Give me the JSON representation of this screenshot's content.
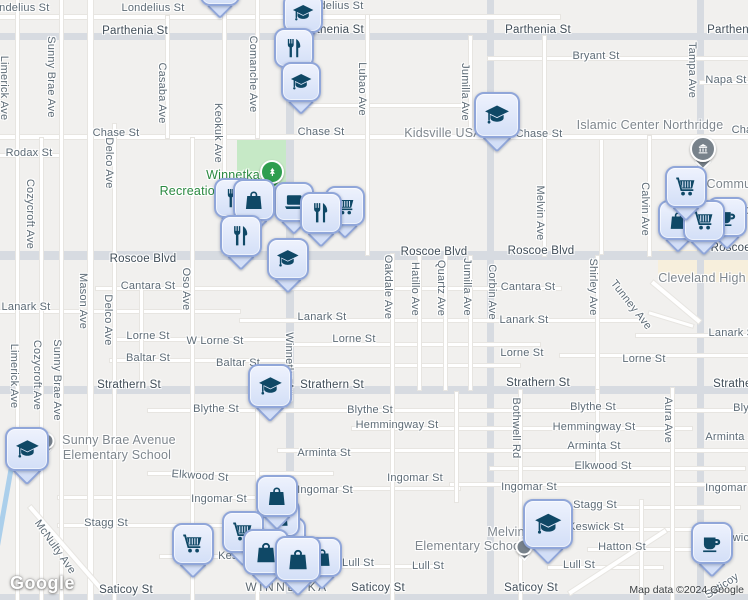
{
  "map_title": "Winnetka area street map",
  "colors": {
    "background": "#f1f0ee",
    "major_road": "#d7dbe1",
    "local_road": "#ffffff",
    "park": "#c6e9c6",
    "water": "#abcfeb",
    "marker_fill": "#d9e3f8",
    "marker_border": "#90a6d9",
    "marker_glyph": "#0f4866",
    "park_pin": "#2e9e4f",
    "institution_pin": "#78828b",
    "street_text": "#5d6b76",
    "major_street_text": "#3f4c57",
    "area_text": "#7e868d",
    "green_text": "#2b8a41"
  },
  "labels": [
    {
      "t": "Londelius St",
      "x": 18,
      "y": 8,
      "r": 0,
      "c": "s"
    },
    {
      "t": "Londelius St",
      "x": 153,
      "y": 8,
      "r": 0,
      "c": "s"
    },
    {
      "t": "Londelius St",
      "x": 332,
      "y": 6,
      "r": 0,
      "c": "s"
    },
    {
      "t": "Parthenia St",
      "x": 135,
      "y": 31,
      "r": 0,
      "c": "m"
    },
    {
      "t": "Parthenia St",
      "x": 331,
      "y": 30,
      "r": 0,
      "c": "m"
    },
    {
      "t": "Parthenia St",
      "x": 538,
      "y": 30,
      "r": 0,
      "c": "m"
    },
    {
      "t": "Parthenia St",
      "x": 740,
      "y": 30,
      "r": 0,
      "c": "m"
    },
    {
      "t": "Bryant St",
      "x": 596,
      "y": 56,
      "r": 0,
      "c": "s"
    },
    {
      "t": "Napa St",
      "x": 726,
      "y": 80,
      "r": 0,
      "c": "s"
    },
    {
      "t": "Chase St",
      "x": 116,
      "y": 133,
      "r": 0,
      "c": "s"
    },
    {
      "t": "Chase St",
      "x": 321,
      "y": 132,
      "r": 0,
      "c": "s"
    },
    {
      "t": "Chase St",
      "x": 539,
      "y": 134,
      "r": 0,
      "c": "s"
    },
    {
      "t": "Chase St",
      "x": 755,
      "y": 130,
      "r": 0,
      "c": "s"
    },
    {
      "t": "Rodax St",
      "x": 29,
      "y": 153,
      "r": 0,
      "c": "s"
    },
    {
      "t": "Roscoe Blvd",
      "x": 143,
      "y": 259,
      "r": 0,
      "c": "m"
    },
    {
      "t": "Roscoe Blvd",
      "x": 434,
      "y": 252,
      "r": 0,
      "c": "m"
    },
    {
      "t": "Roscoe Blvd",
      "x": 541,
      "y": 251,
      "r": 0,
      "c": "m"
    },
    {
      "t": "Roscoe Blvd",
      "x": 744,
      "y": 248,
      "r": 0,
      "c": "m"
    },
    {
      "t": "Cantara St",
      "x": 148,
      "y": 286,
      "r": 0,
      "c": "s"
    },
    {
      "t": "Cantara St",
      "x": 528,
      "y": 287,
      "r": 0,
      "c": "s"
    },
    {
      "t": "Lanark St",
      "x": 26,
      "y": 307,
      "r": 0,
      "c": "s"
    },
    {
      "t": "Lanark St",
      "x": 322,
      "y": 317,
      "r": 0,
      "c": "s"
    },
    {
      "t": "Lanark St",
      "x": 524,
      "y": 320,
      "r": 0,
      "c": "s"
    },
    {
      "t": "Lanark St",
      "x": 733,
      "y": 333,
      "r": 0,
      "c": "s"
    },
    {
      "t": "Lorne St",
      "x": 148,
      "y": 336,
      "r": 0,
      "c": "s"
    },
    {
      "t": "W Lorne St",
      "x": 215,
      "y": 341,
      "r": 0,
      "c": "s"
    },
    {
      "t": "Lorne St",
      "x": 354,
      "y": 339,
      "r": 0,
      "c": "s"
    },
    {
      "t": "Lorne St",
      "x": 522,
      "y": 353,
      "r": 0,
      "c": "s"
    },
    {
      "t": "Lorne St",
      "x": 644,
      "y": 359,
      "r": 0,
      "c": "s"
    },
    {
      "t": "Baltar St",
      "x": 148,
      "y": 358,
      "r": 0,
      "c": "s"
    },
    {
      "t": "Baltar St",
      "x": 238,
      "y": 363,
      "r": 0,
      "c": "s"
    },
    {
      "t": "Strathern St",
      "x": 129,
      "y": 385,
      "r": 0,
      "c": "m"
    },
    {
      "t": "Strathern St",
      "x": 332,
      "y": 385,
      "r": 0,
      "c": "m"
    },
    {
      "t": "Strathern St",
      "x": 538,
      "y": 383,
      "r": 0,
      "c": "m"
    },
    {
      "t": "Strathern St",
      "x": 745,
      "y": 384,
      "r": 0,
      "c": "m"
    },
    {
      "t": "Blythe St",
      "x": 216,
      "y": 409,
      "r": 0,
      "c": "s"
    },
    {
      "t": "Blythe St",
      "x": 370,
      "y": 410,
      "r": 0,
      "c": "s"
    },
    {
      "t": "Blythe St",
      "x": 593,
      "y": 407,
      "r": 0,
      "c": "s"
    },
    {
      "t": "Blythe St",
      "x": 756,
      "y": 408,
      "r": 0,
      "c": "s"
    },
    {
      "t": "Hemmingway St",
      "x": 397,
      "y": 425,
      "r": 0,
      "c": "s"
    },
    {
      "t": "Hemmingway St",
      "x": 594,
      "y": 427,
      "r": 0,
      "c": "s"
    },
    {
      "t": "Arminta St",
      "x": 324,
      "y": 453,
      "r": 0,
      "c": "s"
    },
    {
      "t": "Arminta St",
      "x": 594,
      "y": 446,
      "r": 0,
      "c": "s"
    },
    {
      "t": "Arminta St",
      "x": 732,
      "y": 437,
      "r": 0,
      "c": "s"
    },
    {
      "t": "Elkwood St",
      "x": 200,
      "y": 476,
      "r": 4,
      "c": "s"
    },
    {
      "t": "Elkwood St",
      "x": 603,
      "y": 466,
      "r": 0,
      "c": "s"
    },
    {
      "t": "Ingomar St",
      "x": 219,
      "y": 499,
      "r": 0,
      "c": "s"
    },
    {
      "t": "Ingomar St",
      "x": 325,
      "y": 490,
      "r": 0,
      "c": "s"
    },
    {
      "t": "Ingomar St",
      "x": 415,
      "y": 478,
      "r": 0,
      "c": "s"
    },
    {
      "t": "Ingomar St",
      "x": 529,
      "y": 487,
      "r": 0,
      "c": "s"
    },
    {
      "t": "Ingomar St",
      "x": 733,
      "y": 488,
      "r": 0,
      "c": "s"
    },
    {
      "t": "Stagg St",
      "x": 106,
      "y": 523,
      "r": 0,
      "c": "s"
    },
    {
      "t": "Stagg St",
      "x": 595,
      "y": 505,
      "r": 0,
      "c": "s"
    },
    {
      "t": "Keswick St",
      "x": 246,
      "y": 556,
      "r": 0,
      "c": "s"
    },
    {
      "t": "Keswick St",
      "x": 596,
      "y": 527,
      "r": 0,
      "c": "s"
    },
    {
      "t": "Keswick St",
      "x": 741,
      "y": 538,
      "r": 0,
      "c": "s"
    },
    {
      "t": "Hatton St",
      "x": 622,
      "y": 547,
      "r": 0,
      "c": "s"
    },
    {
      "t": "Lull St",
      "x": 358,
      "y": 563,
      "r": 0,
      "c": "s"
    },
    {
      "t": "Lull St",
      "x": 428,
      "y": 566,
      "r": 0,
      "c": "s"
    },
    {
      "t": "Lull St",
      "x": 579,
      "y": 565,
      "r": 0,
      "c": "s"
    },
    {
      "t": "Saticoy St",
      "x": 126,
      "y": 590,
      "r": 0,
      "c": "m"
    },
    {
      "t": "Saticoy St",
      "x": 378,
      "y": 588,
      "r": 0,
      "c": "m"
    },
    {
      "t": "Saticoy St",
      "x": 531,
      "y": 588,
      "r": 0,
      "c": "m"
    },
    {
      "t": "Saticoy",
      "x": 722,
      "y": 586,
      "r": -33,
      "c": "s"
    },
    {
      "t": "WINNETKA",
      "x": 287,
      "y": 587,
      "r": 0,
      "c": "c"
    },
    {
      "t": "Limerick Ave",
      "x": 4,
      "y": 88,
      "r": 90,
      "c": "s"
    },
    {
      "t": "Sunny Brae Ave",
      "x": 51,
      "y": 77,
      "r": 90,
      "c": "s"
    },
    {
      "t": "Casaba Ave",
      "x": 162,
      "y": 93,
      "r": 90,
      "c": "s"
    },
    {
      "t": "Keokuk Ave",
      "x": 218,
      "y": 133,
      "r": 90,
      "c": "s"
    },
    {
      "t": "Comanche Ave",
      "x": 253,
      "y": 74,
      "r": 90,
      "c": "s"
    },
    {
      "t": "Lubao Ave",
      "x": 362,
      "y": 89,
      "r": 90,
      "c": "s"
    },
    {
      "t": "Jumilla Ave",
      "x": 465,
      "y": 92,
      "r": 90,
      "c": "s"
    },
    {
      "t": "Tampa Ave",
      "x": 692,
      "y": 70,
      "r": 90,
      "c": "s"
    },
    {
      "t": "Cozycroft Ave",
      "x": 30,
      "y": 214,
      "r": 90,
      "c": "s"
    },
    {
      "t": "Delco Ave",
      "x": 109,
      "y": 163,
      "r": 90,
      "c": "s"
    },
    {
      "t": "Mason Ave",
      "x": 83,
      "y": 301,
      "r": 90,
      "c": "s"
    },
    {
      "t": "Delco Ave",
      "x": 108,
      "y": 320,
      "r": 90,
      "c": "s"
    },
    {
      "t": "Oso Ave",
      "x": 186,
      "y": 289,
      "r": 90,
      "c": "s"
    },
    {
      "t": "Winnetka Ave",
      "x": 289,
      "y": 367,
      "r": 90,
      "c": "s"
    },
    {
      "t": "Oakdale Ave",
      "x": 388,
      "y": 287,
      "r": 90,
      "c": "s"
    },
    {
      "t": "Hatillo Ave",
      "x": 415,
      "y": 289,
      "r": 90,
      "c": "s"
    },
    {
      "t": "Quartz Ave",
      "x": 441,
      "y": 288,
      "r": 90,
      "c": "s"
    },
    {
      "t": "Jumilla Ave",
      "x": 467,
      "y": 287,
      "r": 90,
      "c": "s"
    },
    {
      "t": "Corbin Ave",
      "x": 492,
      "y": 292,
      "r": 90,
      "c": "s"
    },
    {
      "t": "Melvin Ave",
      "x": 540,
      "y": 213,
      "r": 90,
      "c": "s"
    },
    {
      "t": "Calvin Ave",
      "x": 645,
      "y": 209,
      "r": 90,
      "c": "s"
    },
    {
      "t": "Shirley Ave",
      "x": 593,
      "y": 287,
      "r": 90,
      "c": "s"
    },
    {
      "t": "Tunney Ave",
      "x": 631,
      "y": 305,
      "r": 52,
      "c": "s"
    },
    {
      "t": "Bothwell Rd",
      "x": 516,
      "y": 428,
      "r": 90,
      "c": "s"
    },
    {
      "t": "Aura Ave",
      "x": 668,
      "y": 420,
      "r": 90,
      "c": "s"
    },
    {
      "t": "Limerick Ave",
      "x": 14,
      "y": 376,
      "r": 90,
      "c": "s"
    },
    {
      "t": "Cozycroft Ave",
      "x": 37,
      "y": 375,
      "r": 90,
      "c": "s"
    },
    {
      "t": "Sunny Brae Ave",
      "x": 57,
      "y": 380,
      "r": 90,
      "c": "s"
    },
    {
      "t": "McNulty Ave",
      "x": 55,
      "y": 547,
      "r": 55,
      "c": "s"
    },
    {
      "t": "Kidsville USA",
      "x": 443,
      "y": 133,
      "r": 0,
      "c": "a"
    },
    {
      "t": "Islamic Center Northridge",
      "x": 650,
      "y": 125,
      "r": 0,
      "c": "a"
    },
    {
      "t": "Cleveland High",
      "x": 702,
      "y": 278,
      "r": 0,
      "c": "a"
    },
    {
      "t": "Sunny Brae Avenue",
      "x": 119,
      "y": 440,
      "r": 0,
      "c": "a"
    },
    {
      "t": "Elementary School",
      "x": 117,
      "y": 455,
      "r": 0,
      "c": "a"
    },
    {
      "t": "Melvin",
      "x": 506,
      "y": 532,
      "r": 0,
      "c": "a"
    },
    {
      "t": "Elementary School",
      "x": 469,
      "y": 546,
      "r": 0,
      "c": "a"
    },
    {
      "t": "Community",
      "x": 739,
      "y": 184,
      "r": 0,
      "c": "a"
    },
    {
      "t": "ho",
      "x": 743,
      "y": 210,
      "r": 0,
      "c": "a"
    },
    {
      "t": "Winnetka",
      "x": 233,
      "y": 175,
      "r": 0,
      "c": "g"
    },
    {
      "t": "Recreation Center",
      "x": 212,
      "y": 191,
      "r": 0,
      "c": "g"
    }
  ],
  "pois": [
    {
      "type": "park-pin",
      "x": 272,
      "y": 172
    },
    {
      "type": "institution-pin",
      "x": 703,
      "y": 149
    },
    {
      "type": "poi-dot",
      "x": 46,
      "y": 441
    },
    {
      "type": "poi-dot",
      "x": 524,
      "y": 547
    }
  ],
  "markers": [
    {
      "glyph": "hidden",
      "x": 220,
      "y": -14,
      "s": 40
    },
    {
      "glyph": "graduation-cap",
      "x": 303,
      "y": 13,
      "s": 40
    },
    {
      "glyph": "restaurant",
      "x": 294,
      "y": 48,
      "s": 40
    },
    {
      "glyph": "graduation-cap",
      "x": 301,
      "y": 82,
      "s": 40
    },
    {
      "glyph": "graduation-cap",
      "x": 497,
      "y": 115,
      "s": 46
    },
    {
      "glyph": "restaurant",
      "x": 234,
      "y": 198,
      "s": 40
    },
    {
      "glyph": "shopping-cart",
      "x": 345,
      "y": 206,
      "s": 40
    },
    {
      "glyph": "laptop",
      "x": 294,
      "y": 202,
      "s": 40
    },
    {
      "glyph": "shopping-bag",
      "x": 254,
      "y": 200,
      "s": 42
    },
    {
      "glyph": "restaurant",
      "x": 321,
      "y": 213,
      "s": 42
    },
    {
      "glyph": "restaurant",
      "x": 241,
      "y": 236,
      "s": 42
    },
    {
      "glyph": "graduation-cap",
      "x": 288,
      "y": 259,
      "s": 42
    },
    {
      "glyph": "coffee-cup",
      "x": 727,
      "y": 217,
      "s": 40
    },
    {
      "glyph": "shopping-bag",
      "x": 678,
      "y": 220,
      "s": 40
    },
    {
      "glyph": "shopping-cart",
      "x": 704,
      "y": 221,
      "s": 42
    },
    {
      "glyph": "shopping-cart",
      "x": 686,
      "y": 187,
      "s": 42
    },
    {
      "glyph": "graduation-cap",
      "x": 270,
      "y": 386,
      "s": 44
    },
    {
      "glyph": "graduation-cap",
      "x": 27,
      "y": 449,
      "s": 44
    },
    {
      "glyph": "graduation-cap",
      "x": 548,
      "y": 524,
      "s": 50
    },
    {
      "glyph": "coffee-cup",
      "x": 712,
      "y": 543,
      "s": 42
    },
    {
      "glyph": "shopping-cart",
      "x": 287,
      "y": 536,
      "s": 38
    },
    {
      "glyph": "shopping-bag",
      "x": 281,
      "y": 518,
      "s": 38
    },
    {
      "glyph": "shopping-bag",
      "x": 277,
      "y": 496,
      "s": 42
    },
    {
      "glyph": "shopping-bag",
      "x": 322,
      "y": 557,
      "s": 40
    },
    {
      "glyph": "shopping-cart",
      "x": 243,
      "y": 532,
      "s": 42
    },
    {
      "glyph": "shopping-bag",
      "x": 266,
      "y": 552,
      "s": 46
    },
    {
      "glyph": "shopping-bag",
      "x": 298,
      "y": 559,
      "s": 46
    },
    {
      "glyph": "shopping-cart",
      "x": 193,
      "y": 544,
      "s": 42
    }
  ],
  "footer": {
    "logo": "Google",
    "attribution": "Map data ©2024 Google"
  }
}
